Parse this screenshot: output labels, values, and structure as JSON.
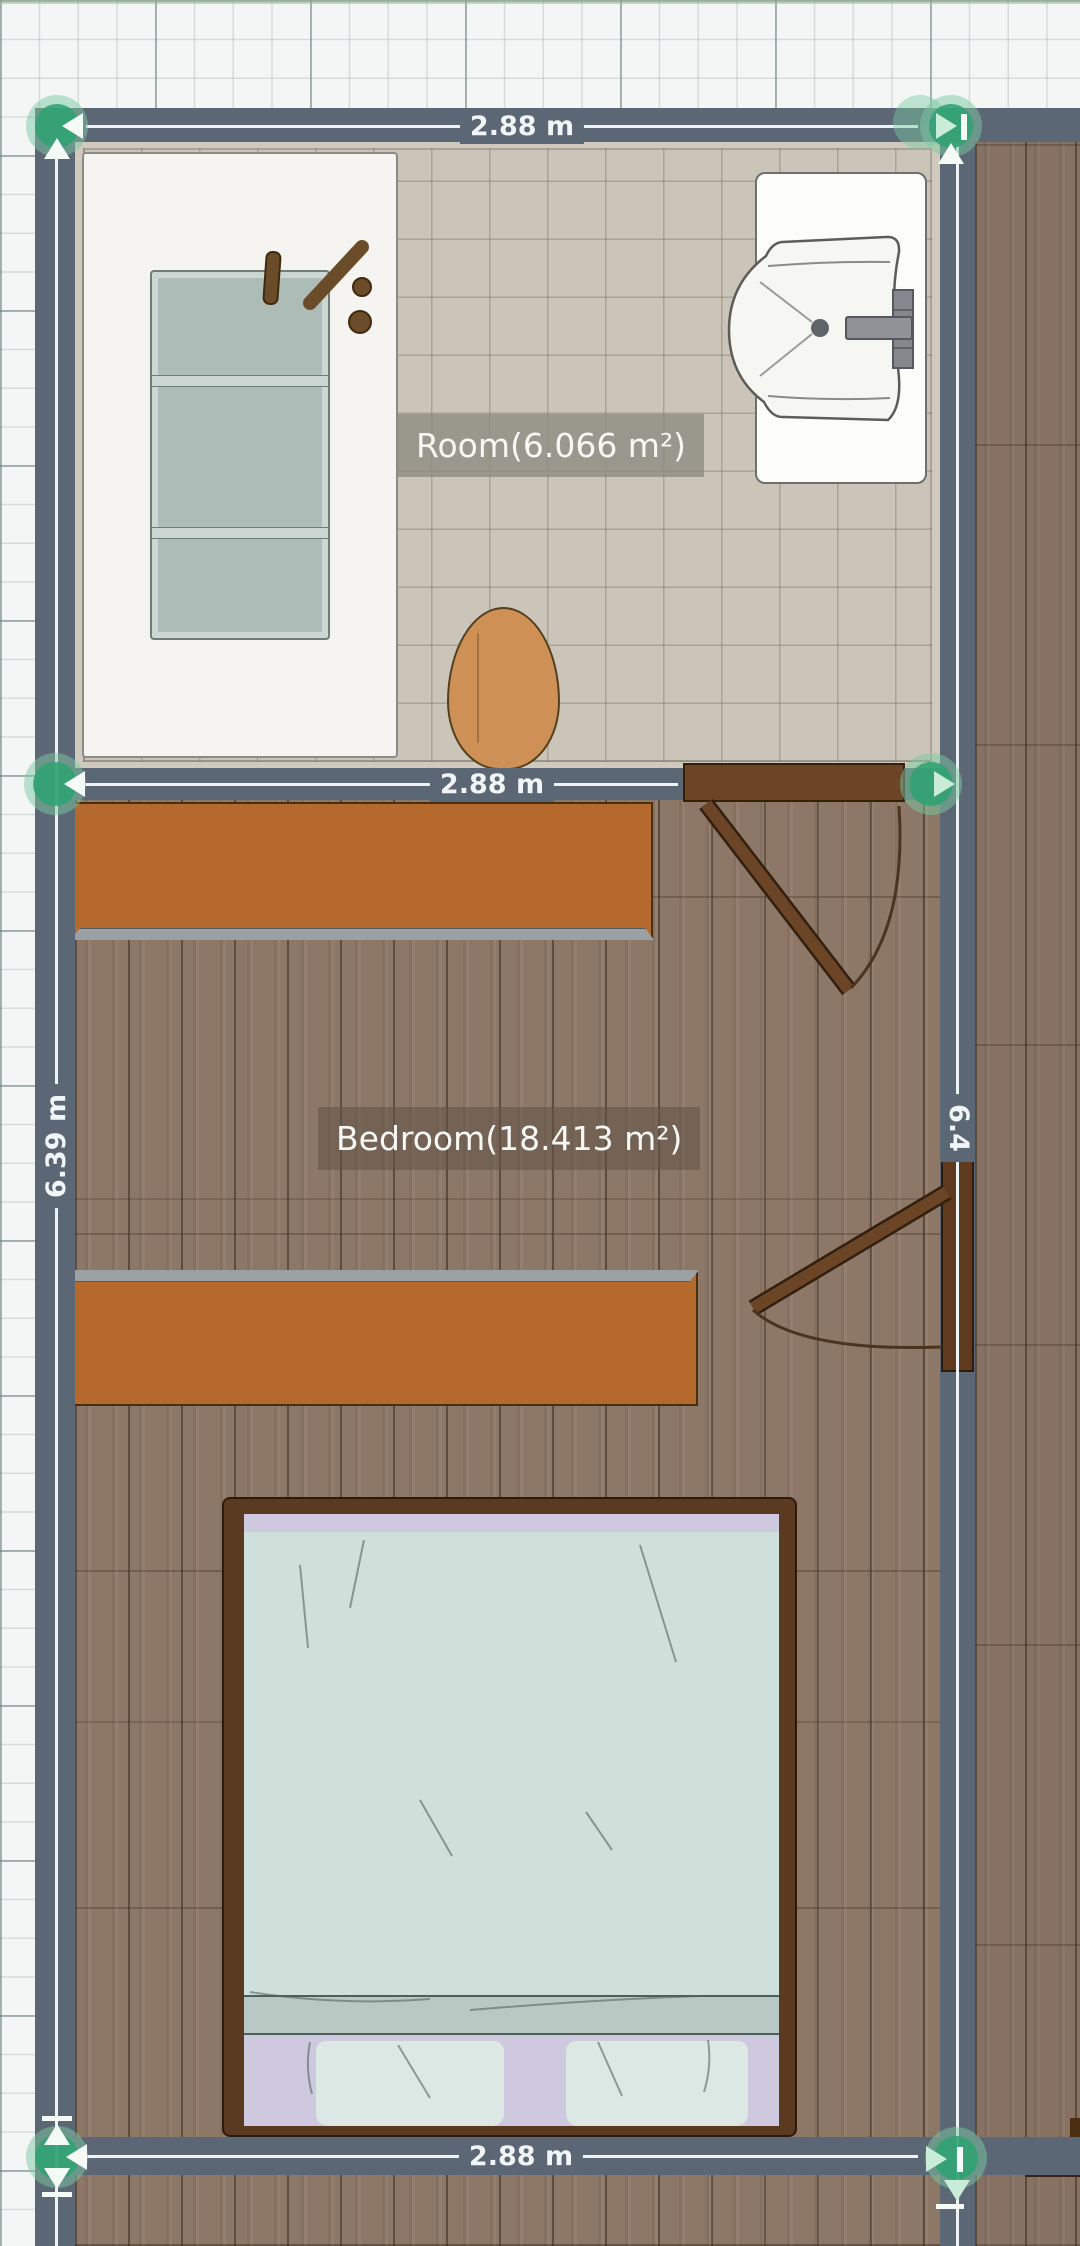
{
  "app": {
    "type": "floor-plan-editor",
    "view": "2d-top-down"
  },
  "rooms": [
    {
      "name": "Room",
      "area_label": "Room(6.066 m²)",
      "floor": "beige-tile"
    },
    {
      "name": "Bedroom",
      "area_label": "Bedroom(18.413 m²)",
      "floor": "wood-plank"
    }
  ],
  "dimensions": {
    "top_wall": "2.88 m",
    "middle_wall": "2.88 m",
    "bottom_wall": "2.88 m",
    "left_wall": "6.39 m",
    "right_wall": "6.4"
  },
  "furniture": [
    {
      "name": "bathtub",
      "room": "Room"
    },
    {
      "name": "sink",
      "room": "Room"
    },
    {
      "name": "toilet",
      "room": "Room"
    },
    {
      "name": "door",
      "room": "Room"
    },
    {
      "name": "dresser",
      "room": "Bedroom"
    },
    {
      "name": "dresser",
      "room": "Bedroom"
    },
    {
      "name": "double-bed",
      "room": "Bedroom"
    },
    {
      "name": "door",
      "room": "Bedroom"
    }
  ],
  "handles": {
    "count": 6,
    "description": "green circular wall-corner drag handles with pale arrow affordances"
  },
  "palette": {
    "wall": "#5c6775",
    "dimline": "#eef3f6",
    "tile": "#cac5b8",
    "wood": "#8d7767",
    "wood2": "#867162",
    "orange": "#b5692c",
    "door": "#6b4526",
    "frame": "#5b3a22",
    "tub": "#aebcb8",
    "blanket": "#cfe0db",
    "sheet": "#cfc9e0",
    "fold": "#b9c8c2",
    "pillow": "#dce8e4",
    "toilet": "#cf9055",
    "handle_green": "#2fa272"
  }
}
